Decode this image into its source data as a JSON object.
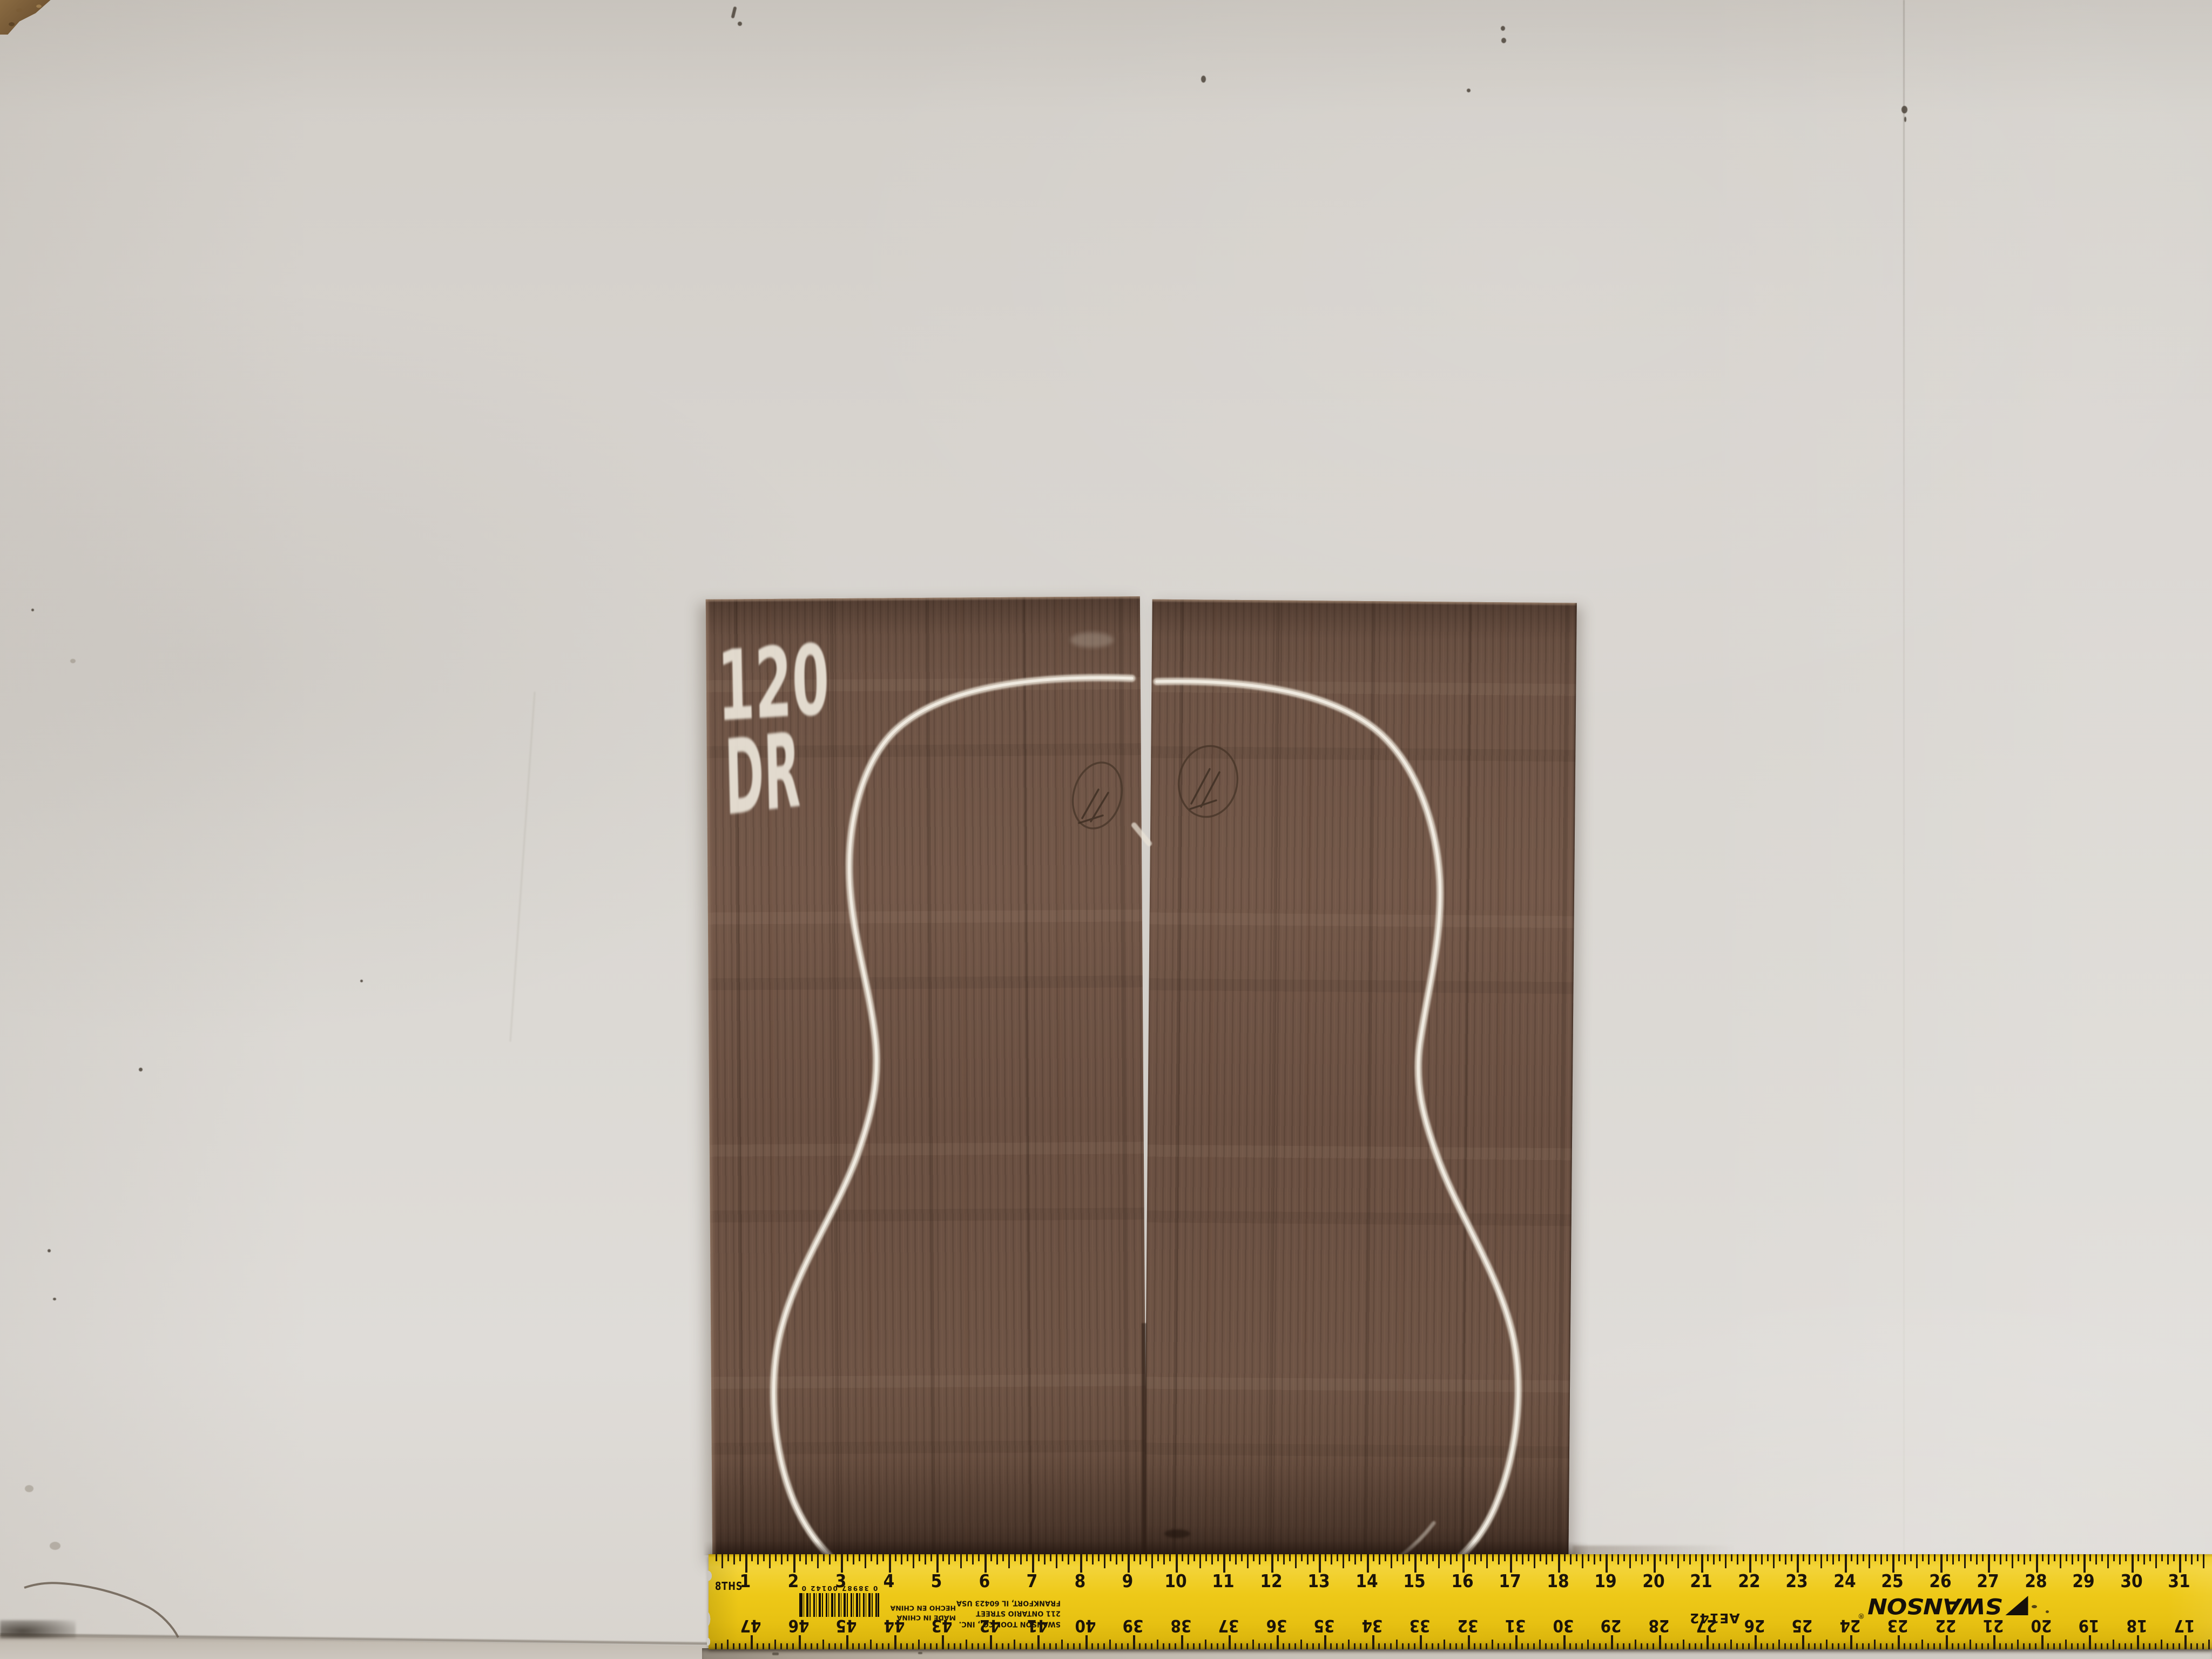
{
  "wood_panels": {
    "chalk_lot_number": "120",
    "chalk_grade": "DR",
    "outline_shape": "dreadnought-guitar-body-chalk-outline",
    "pencil_marks": {
      "left_panel": "11",
      "right_panel": "11"
    },
    "color_base": "#6d5446",
    "chalk_color": "#ece6da"
  },
  "ruler": {
    "brand": "SWANSON",
    "registered_symbol": "®",
    "model": "AE142",
    "scale_label": "8THS",
    "company_lines": [
      "SWANSON TOOL CO., INC.",
      "211 ONTARIO STREET",
      "FRANKFORT, IL 60423 USA"
    ],
    "origin_lines": [
      "MADE IN CHINA",
      "HECHO EN CHINA"
    ],
    "barcode_digits": "0 38987 00142 0",
    "top_numbers": [
      1,
      2,
      3,
      4,
      5,
      6,
      7,
      8,
      9,
      10,
      11,
      12,
      13,
      14,
      15,
      16,
      17,
      18,
      19,
      20,
      21,
      22,
      23,
      24,
      25,
      26,
      27,
      28,
      29,
      30,
      31
    ],
    "bottom_numbers": [
      47,
      46,
      45,
      44,
      43,
      42,
      41,
      40,
      39,
      38,
      37,
      36,
      35,
      34,
      33,
      32,
      31,
      30,
      29,
      28,
      27,
      26,
      25,
      24,
      23,
      22,
      21,
      20,
      19,
      18,
      17
    ],
    "colors": {
      "body_yellow": "#eac613",
      "ink": "#1c1409"
    }
  },
  "colors": {
    "wall": "#d8d4cf",
    "floor": "#c9c4bc"
  }
}
